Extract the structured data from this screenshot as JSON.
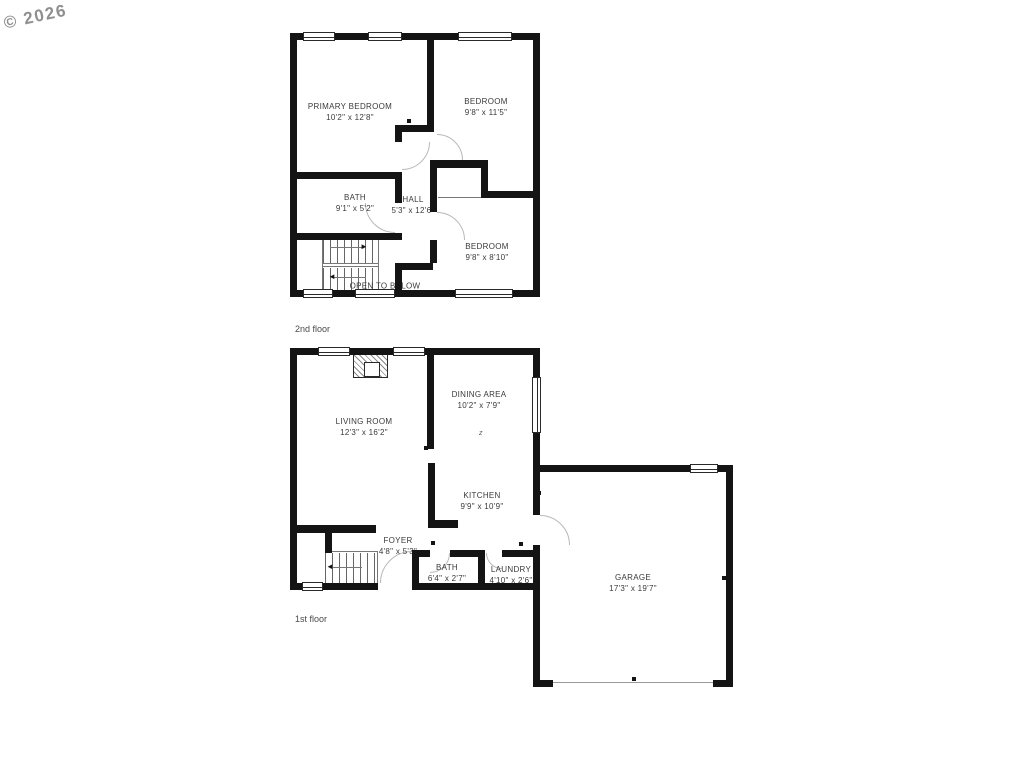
{
  "watermark": {
    "text": "© 2026"
  },
  "floors": [
    {
      "label": "2nd floor",
      "rooms": [
        {
          "name": "PRIMARY BEDROOM",
          "dims": "10'2\" x 12'8\""
        },
        {
          "name": "BEDROOM",
          "dims": "9'8\" x 11'5\""
        },
        {
          "name": "BATH",
          "dims": "9'1\" x 5'2\""
        },
        {
          "name": "HALL",
          "dims": "5'3\" x 12'6\""
        },
        {
          "name": "BEDROOM",
          "dims": "9'8\" x 8'10\""
        }
      ],
      "annotations": {
        "open_to_below": "OPEN TO BELOW"
      }
    },
    {
      "label": "1st floor",
      "rooms": [
        {
          "name": "LIVING ROOM",
          "dims": "12'3\" x 16'2\""
        },
        {
          "name": "DINING AREA",
          "dims": "10'2\" x 7'9\""
        },
        {
          "name": "KITCHEN",
          "dims": "9'9\" x 10'9\""
        },
        {
          "name": "FOYER",
          "dims": "4'8\" x 5'3\""
        },
        {
          "name": "BATH",
          "dims": "6'4\" x 2'7\""
        },
        {
          "name": "LAUNDRY",
          "dims": "4'10\" x 2'6\""
        },
        {
          "name": "GARAGE",
          "dims": "17'3\" x 19'7\""
        }
      ]
    }
  ],
  "icons": {
    "stair_arrow_right": "►",
    "stair_arrow_left": "◄",
    "switch_symbol": "z"
  },
  "colors": {
    "wall": "#141414",
    "label_text": "#3a3a3a",
    "watermark": "#8f8f8f",
    "door_arc": "#b8b8b8",
    "background": "#ffffff"
  }
}
